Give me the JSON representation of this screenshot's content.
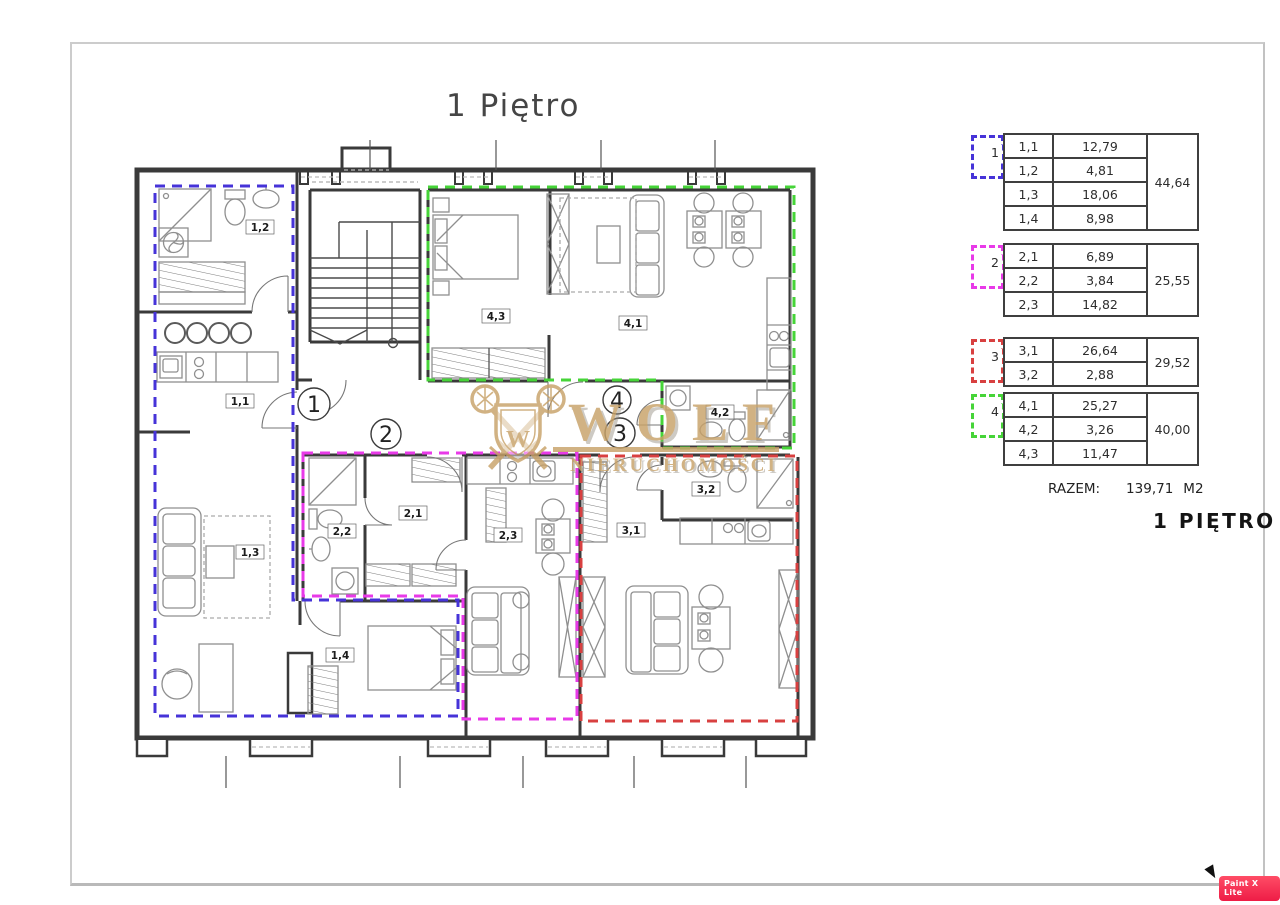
{
  "page": {
    "title": "1 Piętro",
    "app_badge": "Paint X Lite"
  },
  "colors": {
    "apt1": "#4633d8",
    "apt2": "#e83ae8",
    "apt3": "#d84040",
    "apt4": "#46d438",
    "wall": "#3a3a3a",
    "furniture": "#8f8f8f",
    "gold": "#c8a268",
    "gold_shadow": "#9b9489",
    "badge": "#f42a50"
  },
  "plan": {
    "markers": [
      "1",
      "2",
      "3",
      "4"
    ],
    "room_labels": [
      "1,1",
      "1,2",
      "1,3",
      "1,4",
      "2,1",
      "2,2",
      "2,3",
      "3,1",
      "3,2",
      "4,1",
      "4,2",
      "4,3"
    ]
  },
  "watermark": {
    "name": "WOLF",
    "subtitle": "NIERUCHOMOŚCI",
    "monogram": "W"
  },
  "area_table": {
    "groups": [
      {
        "number": "1",
        "rows": [
          [
            "1,1",
            "12,79"
          ],
          [
            "1,2",
            "4,81"
          ],
          [
            "1,3",
            "18,06"
          ],
          [
            "1,4",
            "8,98"
          ]
        ],
        "total": "44,64"
      },
      {
        "number": "2",
        "rows": [
          [
            "2,1",
            "6,89"
          ],
          [
            "2,2",
            "3,84"
          ],
          [
            "2,3",
            "14,82"
          ]
        ],
        "total": "25,55"
      },
      {
        "number": "3",
        "rows": [
          [
            "3,1",
            "26,64"
          ],
          [
            "3,2",
            "2,88"
          ]
        ],
        "total": "29,52"
      },
      {
        "number": "4",
        "rows": [
          [
            "4,1",
            "25,27"
          ],
          [
            "4,2",
            "3,26"
          ],
          [
            "4,3",
            "11,47"
          ]
        ],
        "total": "40,00"
      }
    ],
    "total_label": "RAZEM:",
    "total_value": "139,71",
    "total_unit": "M2",
    "caption": "1 PIĘTRO"
  }
}
